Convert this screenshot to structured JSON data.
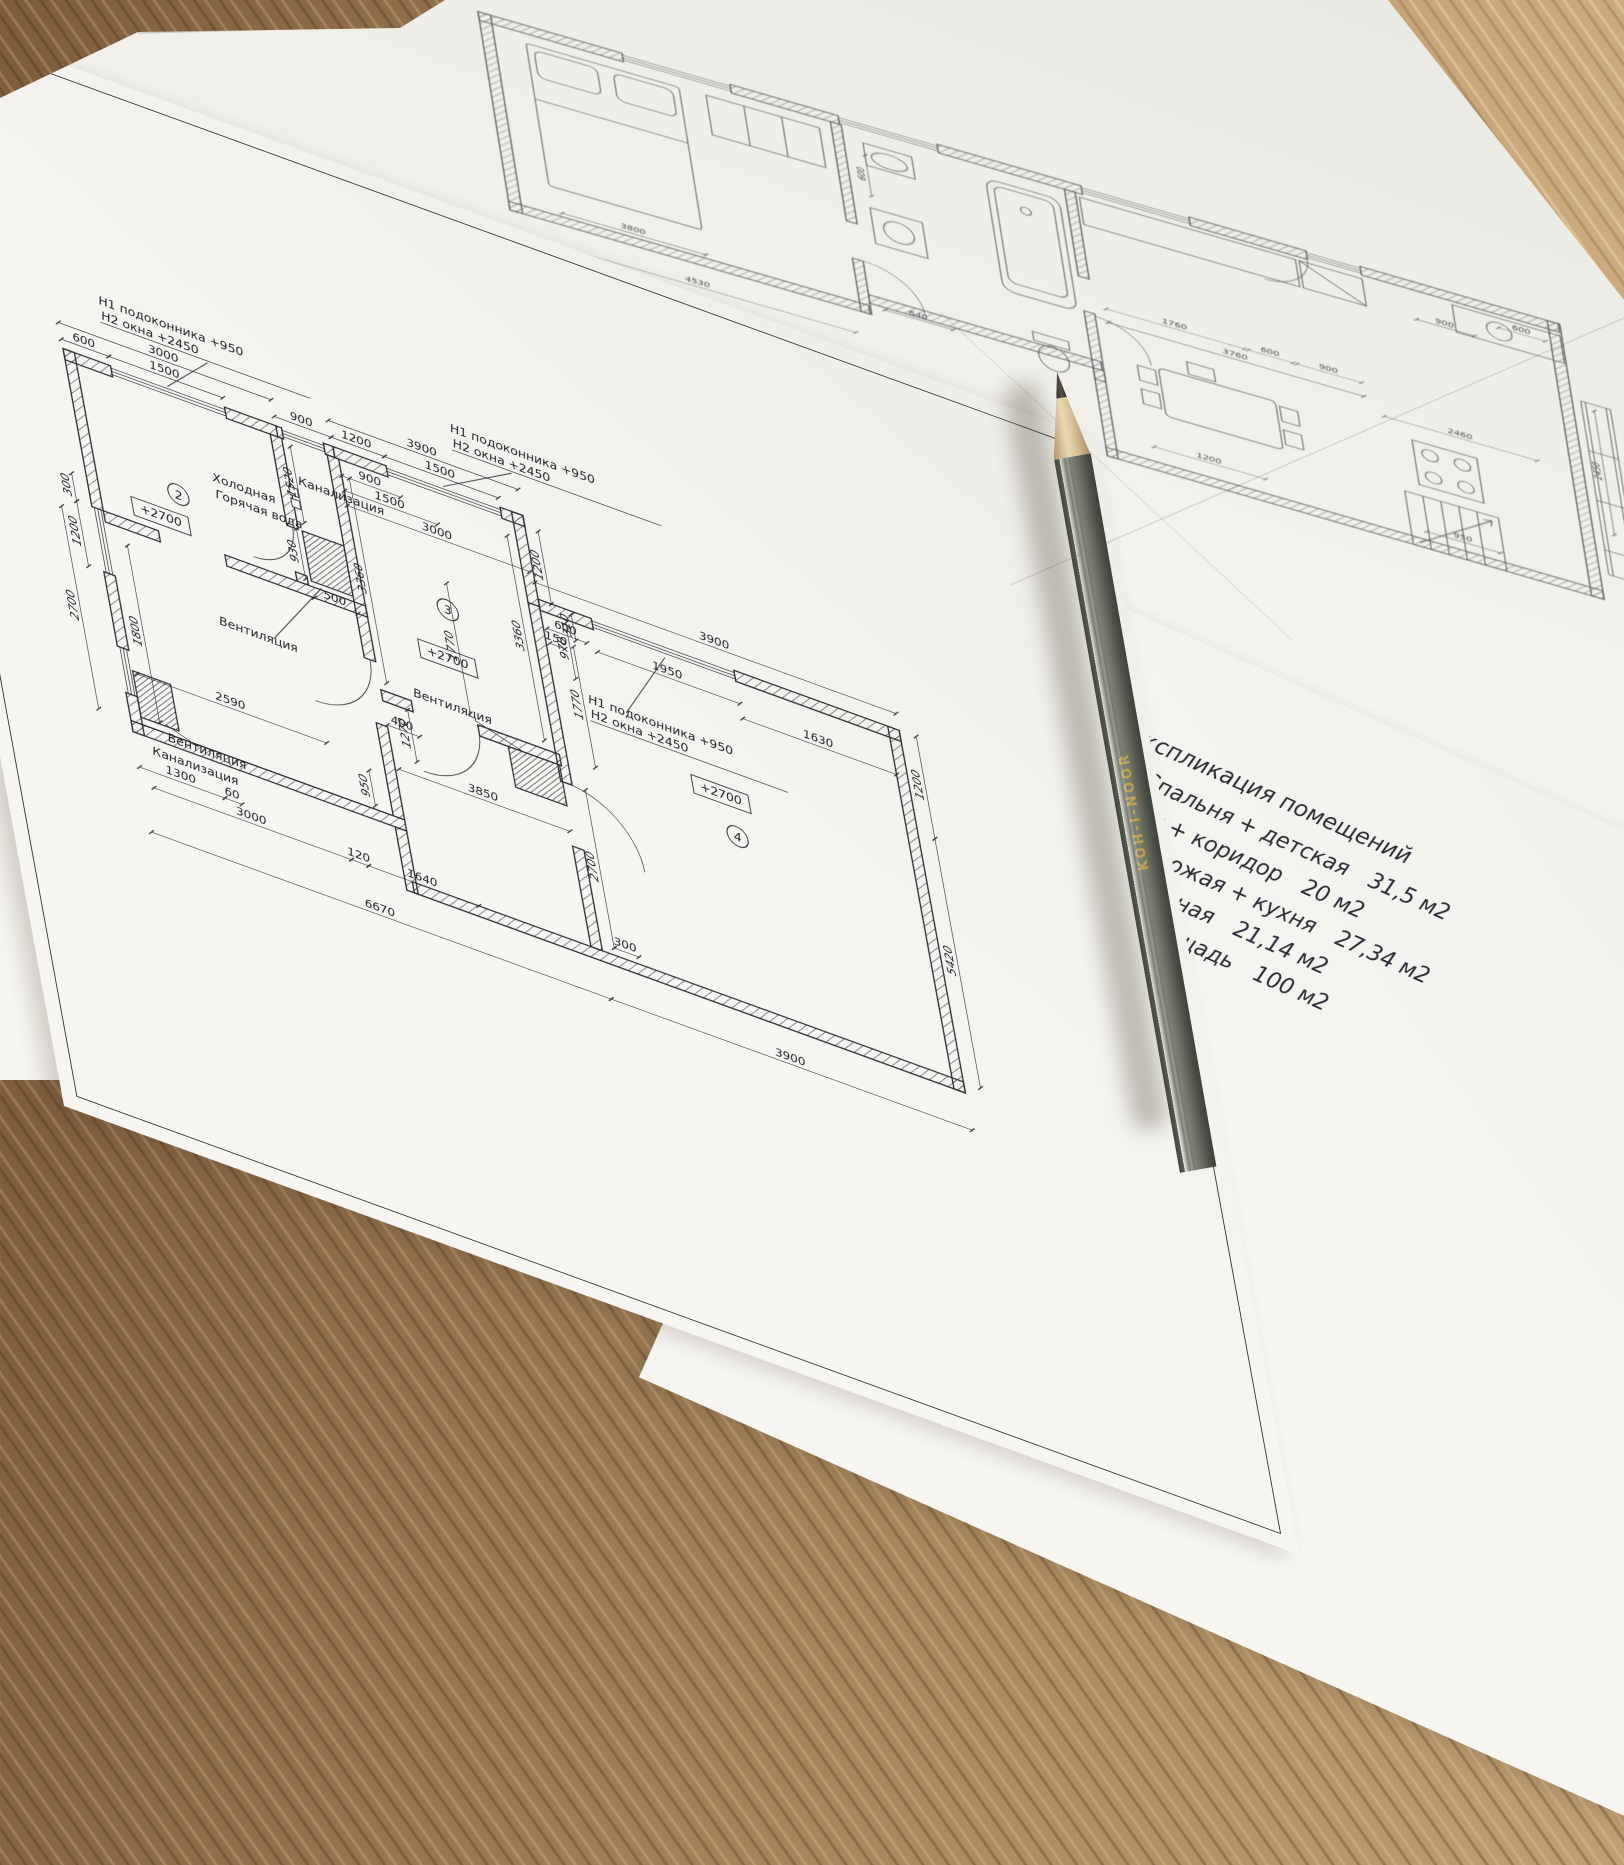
{
  "colors": {
    "ink": "#2c2c34",
    "paper": "#f4f3ef",
    "wood_table": "#96754f",
    "pencil_body": "#5d6157",
    "pencil_brand_gold": "#c2a054"
  },
  "pencil": {
    "brand_text": "KOH-I-NOOR"
  },
  "legend": {
    "title": "Экспликация помещений",
    "rows": [
      {
        "num": "1",
        "name": "Спальня + детская",
        "area": "31,5 м2"
      },
      {
        "num": "2",
        "name": "С/у + коридор",
        "area": "20 м2"
      },
      {
        "num": "3",
        "name": "Прихожая + кухня",
        "area": "27,34 м2"
      },
      {
        "num": "4",
        "name": "Гостинная",
        "area": "21,14 м2"
      }
    ],
    "total_label": "Общая площадь",
    "total_value": "100 м2"
  },
  "front_plan": {
    "window_note": {
      "line1": "Н1 подоконника  +950",
      "line2": "Н2 окна  +2450"
    },
    "level_mark": "+2700",
    "rooms": [
      {
        "num": "2"
      },
      {
        "num": "3"
      },
      {
        "num": "4"
      }
    ],
    "labels": {
      "vent": "Вентиляция",
      "sewer": "Канализация",
      "cold": "Холодная",
      "hot": "Горячая вода"
    },
    "dims": [
      "600",
      "1500",
      "3000",
      "900",
      "300",
      "1200",
      "2700",
      "1800",
      "1300",
      "60",
      "3000",
      "120",
      "1640",
      "6670",
      "2590",
      "3850",
      "950",
      "1270",
      "400",
      "500",
      "930",
      "1200",
      "1500",
      "3900",
      "1200",
      "3360",
      "3360",
      "900",
      "1500",
      "3000",
      "600",
      "150",
      "970",
      "1520",
      "1950",
      "1630",
      "3900",
      "1200",
      "5420",
      "2700",
      "300",
      "3900",
      "310",
      "1770",
      "2010"
    ]
  },
  "back_plan": {
    "dims": [
      "3800",
      "4530",
      "600",
      "640",
      "1760",
      "600",
      "900",
      "3760",
      "2460",
      "1200",
      "950",
      "2450",
      "900",
      "600"
    ]
  }
}
